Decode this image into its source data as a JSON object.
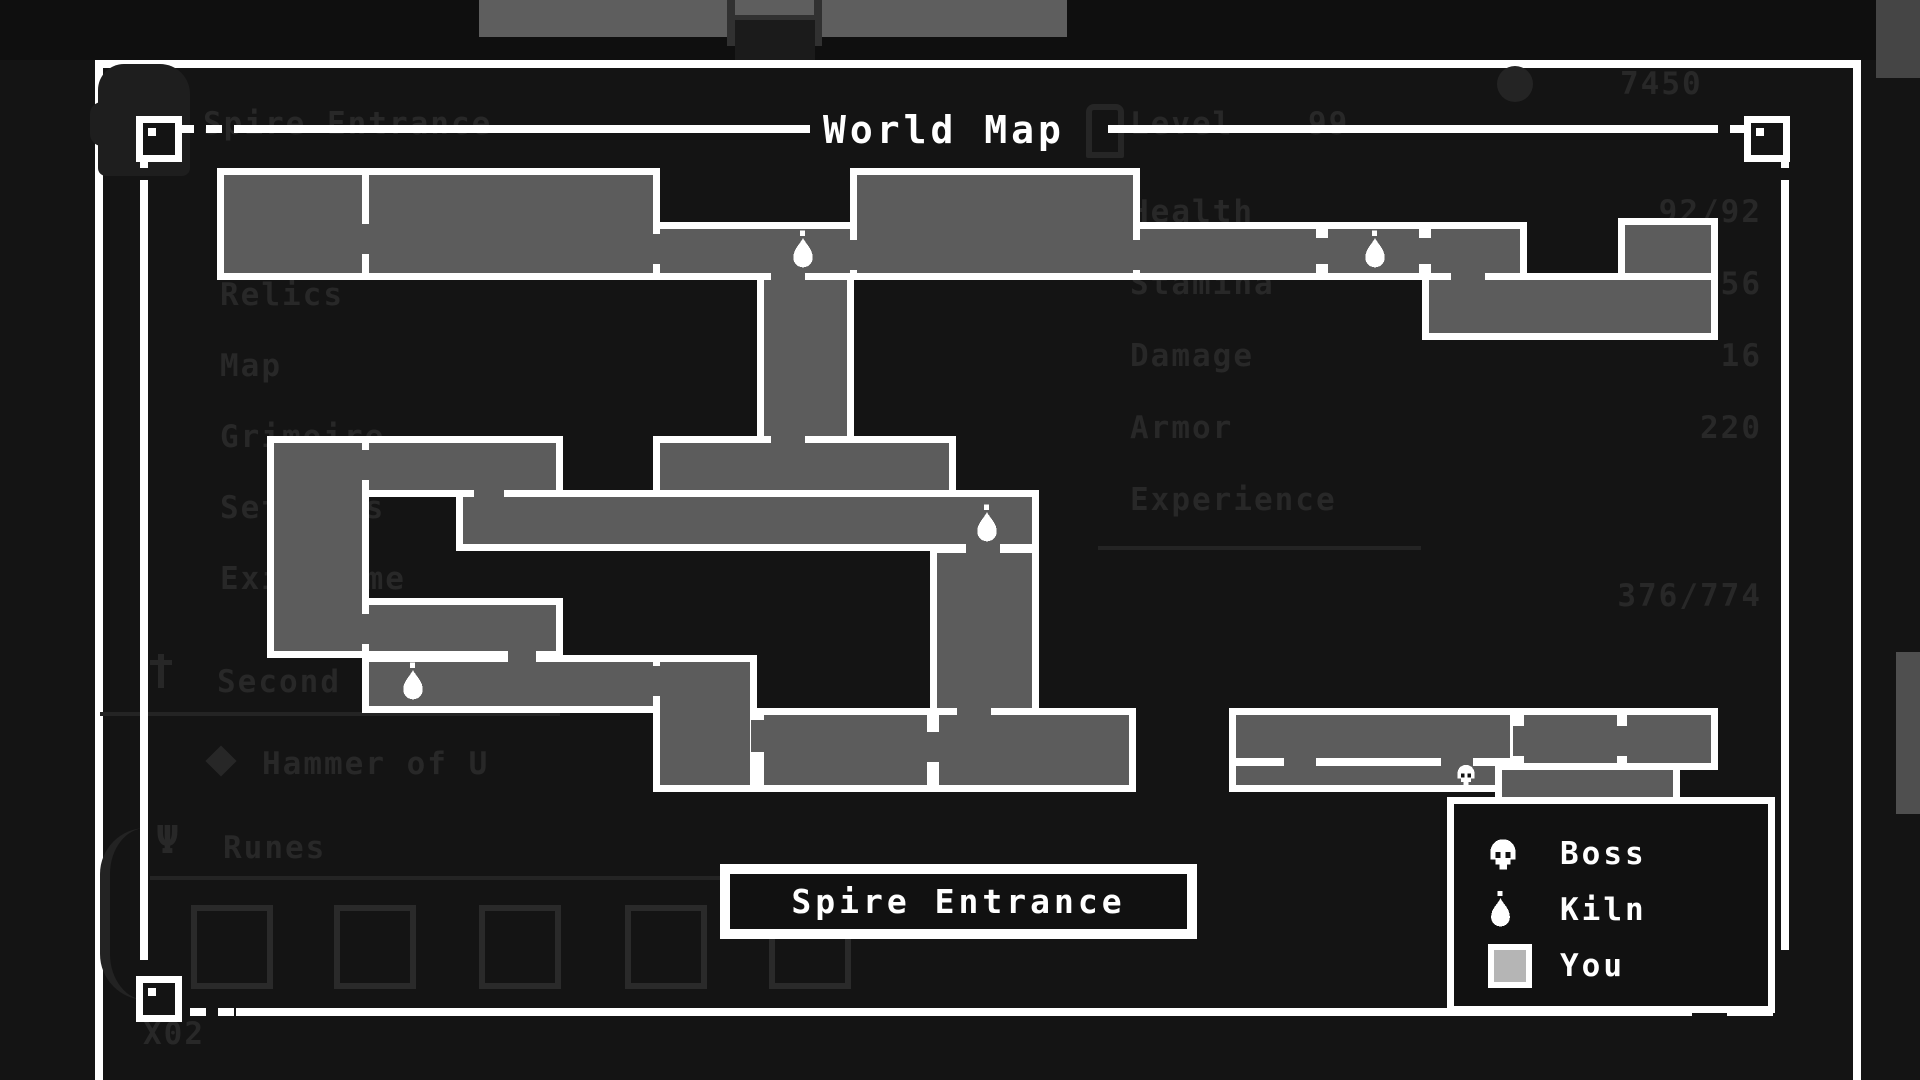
{
  "app": {
    "title": "World Map"
  },
  "hud": {
    "currency": "7450",
    "bottom_left_text": "X02"
  },
  "menu": {
    "selected_item": "Spire Entrance",
    "items": [
      "Relics",
      "Map",
      "Grimoire",
      "Settings",
      "Exit Game"
    ],
    "weapon_primary": "Second",
    "weapon_secondary": "Hammer of U",
    "runes_label": "Runes"
  },
  "stats": {
    "level_label": "Level",
    "level_value": "99",
    "rows": [
      {
        "label": "Health",
        "value": "92/92"
      },
      {
        "label": "Stamina",
        "value": "56"
      },
      {
        "label": "Damage",
        "value": "16"
      },
      {
        "label": "Armor",
        "value": "220"
      },
      {
        "label": "Experience",
        "value": ""
      }
    ],
    "experience_detail": "376/774"
  },
  "map": {
    "location_label": "Spire Entrance",
    "room_color": "#5c5c5c",
    "rooms": [
      [
        217,
        168,
        152,
        112
      ],
      [
        362,
        168,
        298,
        112
      ],
      [
        653,
        222,
        204,
        58
      ],
      [
        850,
        168,
        290,
        112
      ],
      [
        1133,
        222,
        394,
        58
      ],
      [
        1618,
        218,
        100,
        122
      ],
      [
        1422,
        273,
        296,
        67
      ],
      [
        757,
        273,
        97,
        172
      ],
      [
        267,
        436,
        102,
        222
      ],
      [
        362,
        436,
        201,
        61
      ],
      [
        653,
        436,
        303,
        61
      ],
      [
        456,
        490,
        583,
        61
      ],
      [
        930,
        546,
        109,
        170
      ],
      [
        362,
        598,
        201,
        60
      ],
      [
        362,
        655,
        298,
        58
      ],
      [
        653,
        655,
        104,
        137
      ],
      [
        757,
        708,
        379,
        84
      ],
      [
        1229,
        708,
        288,
        84
      ],
      [
        1517,
        708,
        107,
        84
      ],
      [
        1620,
        708,
        98,
        62
      ],
      [
        1495,
        763,
        185,
        45
      ]
    ],
    "doors": [
      [
        356,
        224,
        14,
        30
      ],
      [
        647,
        234,
        14,
        30
      ],
      [
        844,
        240,
        14,
        30
      ],
      [
        1127,
        240,
        14,
        30
      ],
      [
        1451,
        271,
        34,
        12
      ],
      [
        771,
        271,
        34,
        14
      ],
      [
        771,
        436,
        34,
        14
      ],
      [
        474,
        488,
        30,
        14
      ],
      [
        650,
        500,
        14,
        32
      ],
      [
        966,
        544,
        34,
        14
      ],
      [
        356,
        450,
        14,
        30
      ],
      [
        356,
        614,
        14,
        30
      ],
      [
        508,
        650,
        28,
        12
      ],
      [
        456,
        666,
        14,
        30
      ],
      [
        650,
        666,
        14,
        30
      ],
      [
        751,
        720,
        14,
        32
      ],
      [
        957,
        704,
        34,
        14
      ],
      [
        1513,
        726,
        14,
        30
      ],
      [
        1616,
        726,
        14,
        30
      ],
      [
        927,
        732,
        12,
        30
      ],
      [
        1284,
        756,
        32,
        12
      ],
      [
        1441,
        756,
        32,
        12
      ]
    ],
    "stubs": [
      [
        1316,
        222,
        12,
        16
      ],
      [
        1316,
        264,
        12,
        16
      ],
      [
        1419,
        222,
        12,
        16
      ],
      [
        1419,
        264,
        12,
        16
      ],
      [
        927,
        708,
        12,
        26
      ],
      [
        927,
        760,
        12,
        28
      ],
      [
        1229,
        758,
        288,
        8
      ]
    ],
    "kilns": [
      {
        "x": 790,
        "y": 230
      },
      {
        "x": 1362,
        "y": 230
      },
      {
        "x": 400,
        "y": 662
      },
      {
        "x": 974,
        "y": 504
      }
    ],
    "boss_marker": {
      "x": 1453,
      "y": 764
    }
  },
  "legend": {
    "items": [
      {
        "icon": "skull-icon",
        "label": "Boss"
      },
      {
        "icon": "flame-icon",
        "label": "Kiln"
      },
      {
        "icon": "player-square-icon",
        "label": "You"
      }
    ]
  },
  "runes": {
    "slot_x": [
      191,
      334,
      479,
      625,
      769
    ]
  },
  "colors": {
    "background": "#141414",
    "room_gray": "#5c5c5c",
    "white": "#ffffff",
    "faint_text": "#282828",
    "top_bar": "#5e5e5e",
    "you_marker": "#b5b5b5"
  }
}
